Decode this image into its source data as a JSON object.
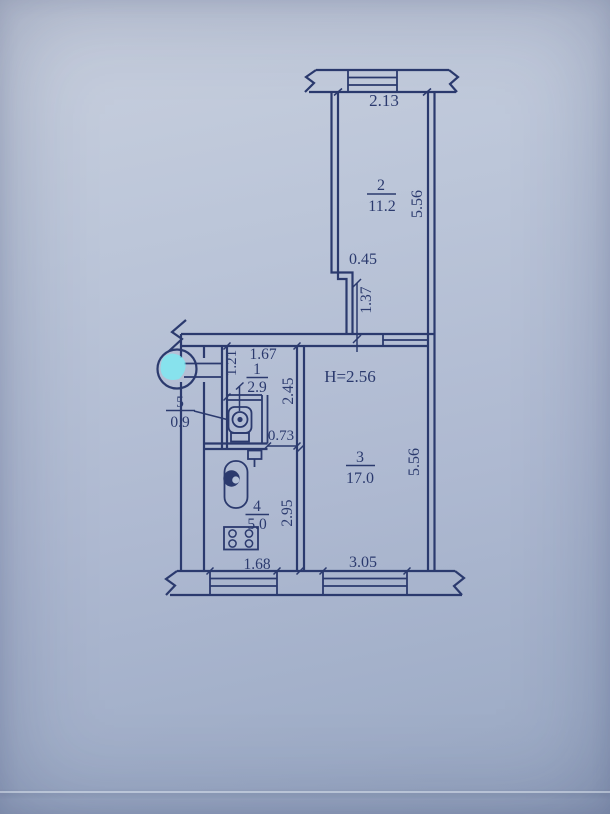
{
  "photo": {
    "paper_color": "#b4c1d8",
    "ink_color": "#2b3a6e",
    "highlight_color": "#7de9f2"
  },
  "plan": {
    "ceiling_height_note": "H=2.56",
    "rooms": [
      {
        "number": "2",
        "area": "11.2"
      },
      {
        "number": "1",
        "area": "2.9"
      },
      {
        "number": "3",
        "area": "17.0"
      },
      {
        "number": "4",
        "area": "5.0"
      },
      {
        "number": "5",
        "area": "0.9"
      }
    ],
    "dimensions": {
      "room2_window_width": "2.13",
      "room2_wall_jog": "0.45",
      "room2_pier": "1.37",
      "room2_depth": "5.56",
      "hall_width": "1.67",
      "hall_entry_side": "1.21",
      "hall_depth": "2.45",
      "kitchen_door_width": "0.73",
      "kitchen_depth": "2.95",
      "kitchen_window_width": "1.68",
      "room3_depth": "5.56",
      "room3_window_width": "3.05"
    }
  }
}
